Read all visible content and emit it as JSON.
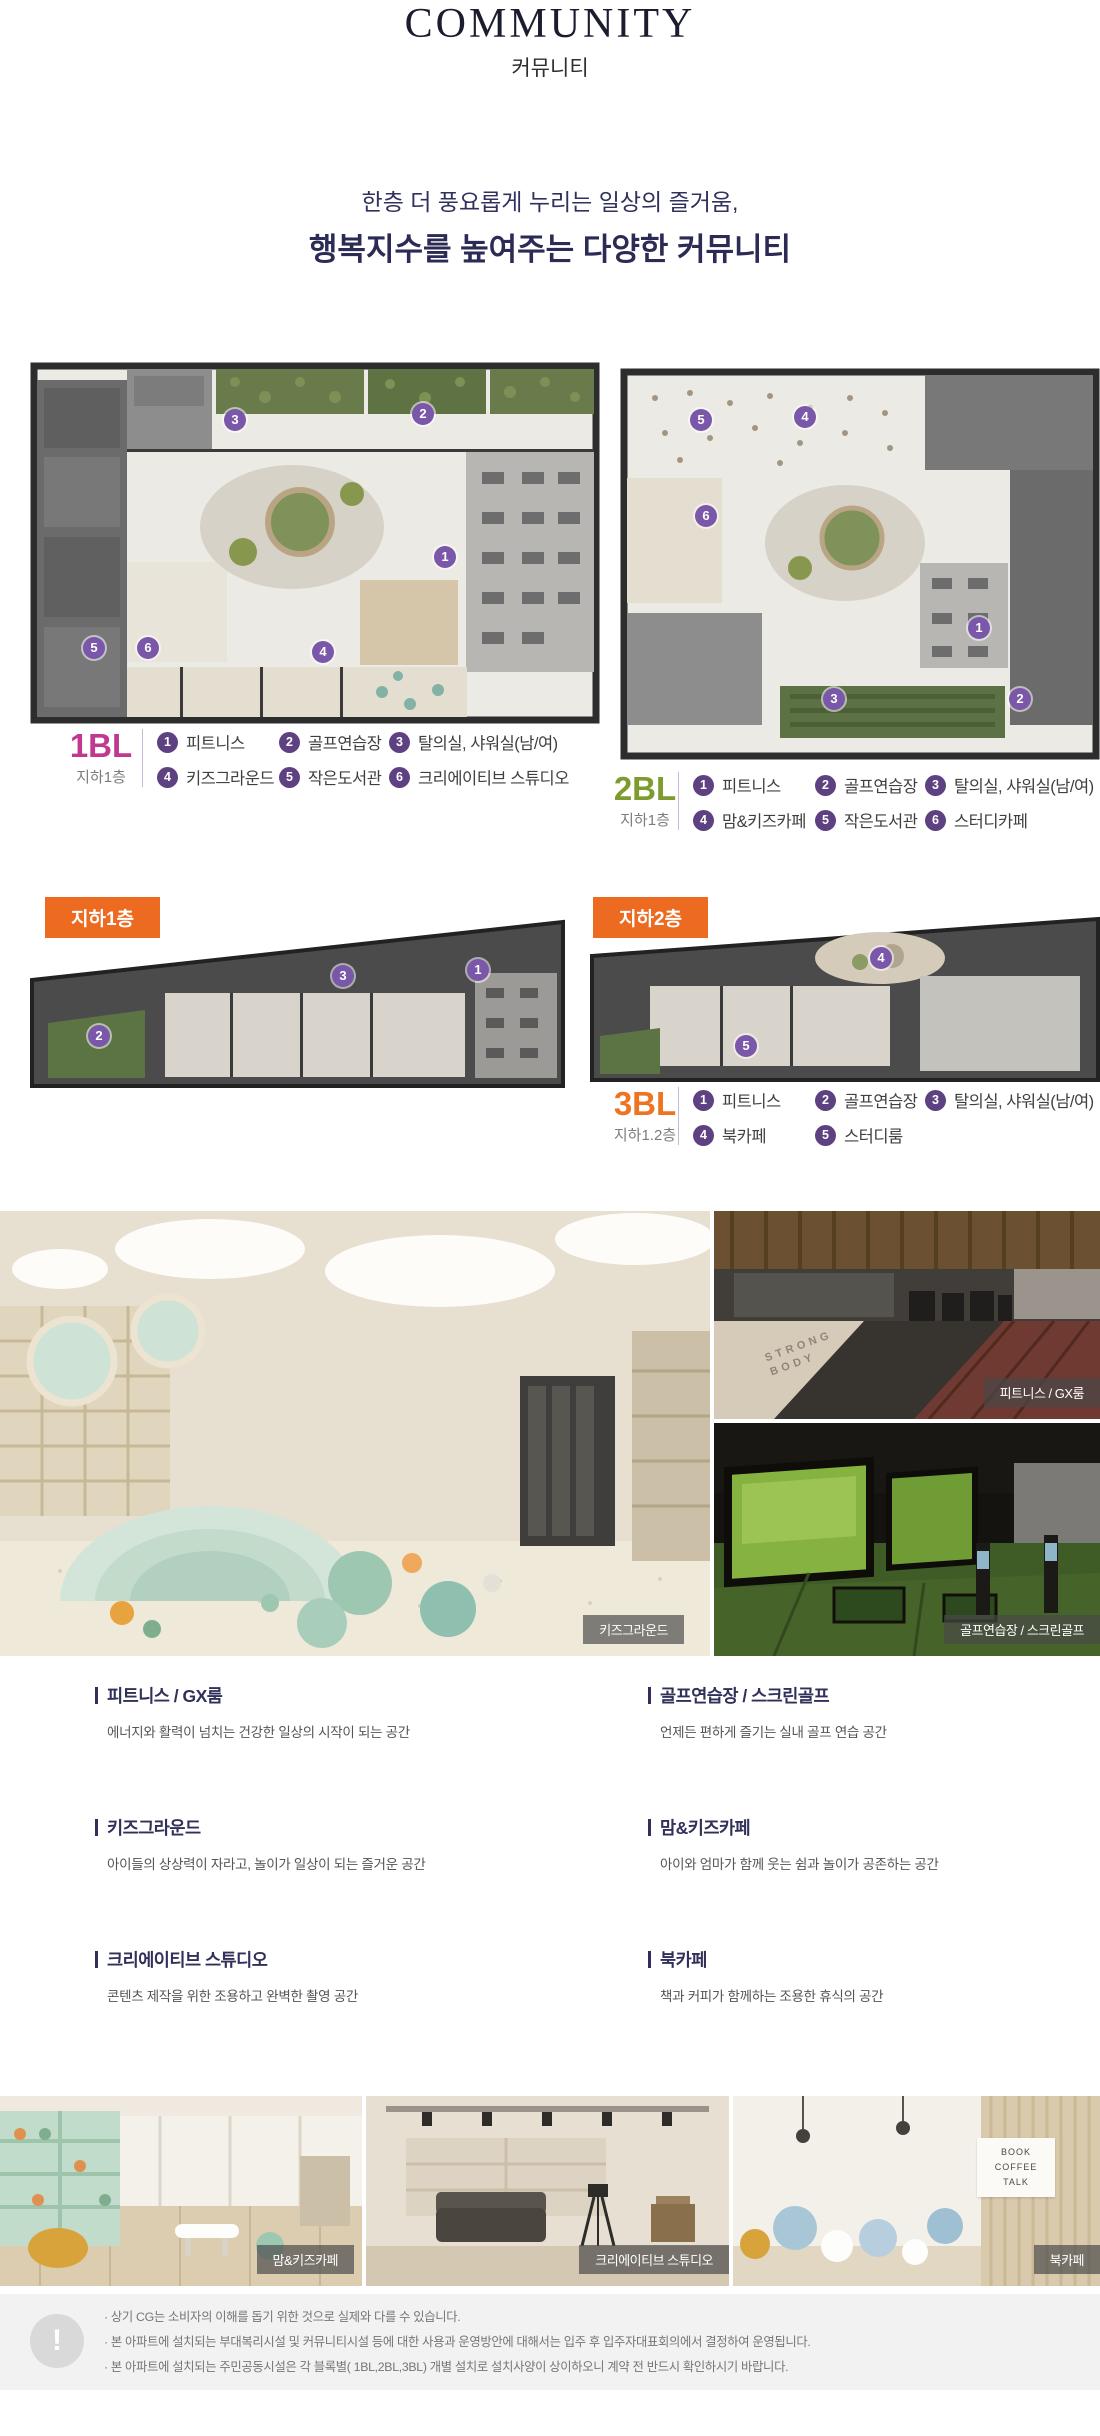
{
  "header": {
    "title": "COMMUNITY",
    "subtitle": "커뮤니티"
  },
  "intro": {
    "line1": "한층 더 풍요롭게 누리는 일상의 즐거움,",
    "line2": "행복지수를 높여주는 다양한 커뮤니티"
  },
  "accent_colors": {
    "bl1": "#c0398f",
    "bl2": "#7d9b2f",
    "bl3": "#ef7422",
    "badge": "#ed6b21",
    "marker": "#7a57a8",
    "legend_circle": "#5d4180",
    "navy": "#30305a"
  },
  "blocks": [
    {
      "name": "1BL",
      "floor": "지하1층",
      "items": [
        {
          "num": "1",
          "label": "피트니스"
        },
        {
          "num": "2",
          "label": "골프연습장"
        },
        {
          "num": "3",
          "label": "탈의실, 샤워실(남/여)"
        },
        {
          "num": "4",
          "label": "키즈그라운드"
        },
        {
          "num": "5",
          "label": "작은도서관"
        },
        {
          "num": "6",
          "label": "크리에이티브 스튜디오"
        }
      ]
    },
    {
      "name": "2BL",
      "floor": "지하1층",
      "items": [
        {
          "num": "1",
          "label": "피트니스"
        },
        {
          "num": "2",
          "label": "골프연습장"
        },
        {
          "num": "3",
          "label": "탈의실, 샤워실(남/여)"
        },
        {
          "num": "4",
          "label": "맘&키즈카페"
        },
        {
          "num": "5",
          "label": "작은도서관"
        },
        {
          "num": "6",
          "label": "스터디카페"
        }
      ]
    },
    {
      "name": "3BL",
      "floor": "지하1.2층",
      "items": [
        {
          "num": "1",
          "label": "피트니스"
        },
        {
          "num": "2",
          "label": "골프연습장"
        },
        {
          "num": "3",
          "label": "탈의실, 샤워실(남/여)"
        },
        {
          "num": "4",
          "label": "북카페"
        },
        {
          "num": "5",
          "label": "스터디룸"
        }
      ]
    }
  ],
  "floor_badges": [
    "지하1층",
    "지하2층"
  ],
  "photos": {
    "kids": {
      "caption": "키즈그라운드"
    },
    "fitness": {
      "caption": "피트니스 / GX룸",
      "mat_text": "STRONG\nBODY"
    },
    "golf": {
      "caption": "골프연습장 / 스크린골프"
    },
    "bottom": [
      {
        "caption": "맘&키즈카페"
      },
      {
        "caption": "크리에이티브 스튜디오"
      },
      {
        "caption": "북카페",
        "sign_text": "BOOK\nCOFFEE\nTALK"
      }
    ]
  },
  "features": [
    {
      "title": "피트니스 / GX룸",
      "desc": "에너지와 활력이 넘치는 건강한 일상의 시작이 되는 공간"
    },
    {
      "title": "골프연습장 / 스크린골프",
      "desc": "언제든 편하게 즐기는 실내 골프 연습 공간"
    },
    {
      "title": "키즈그라운드",
      "desc": "아이들의 상상력이 자라고, 놀이가 일상이 되는 즐거운 공간"
    },
    {
      "title": "맘&키즈카페",
      "desc": "아이와 엄마가 함께 웃는 쉼과 놀이가 공존하는 공간"
    },
    {
      "title": "크리에이티브 스튜디오",
      "desc": "콘텐츠 제작을 위한 조용하고 완벽한 촬영 공간"
    },
    {
      "title": "북카페",
      "desc": "책과 커피가 함께하는 조용한 휴식의 공간"
    }
  ],
  "notice": {
    "icon": "!",
    "lines": [
      "· 상기 CG는 소비자의 이해를 돕기 위한 것으로 실제와 다를 수 있습니다.",
      "· 본 아파트에 설치되는 부대복리시설 및 커뮤니티시설 등에 대한 사용과 운영방안에 대해서는 입주 후 입주자대표회의에서 결정하여 운영됩니다.",
      "· 본 아파트에 설치되는 주민공동시설은 각 블록별( 1BL,2BL,3BL) 개별 설치로 설치사양이 상이하오니 계약 전 반드시 확인하시기 바랍니다."
    ]
  }
}
